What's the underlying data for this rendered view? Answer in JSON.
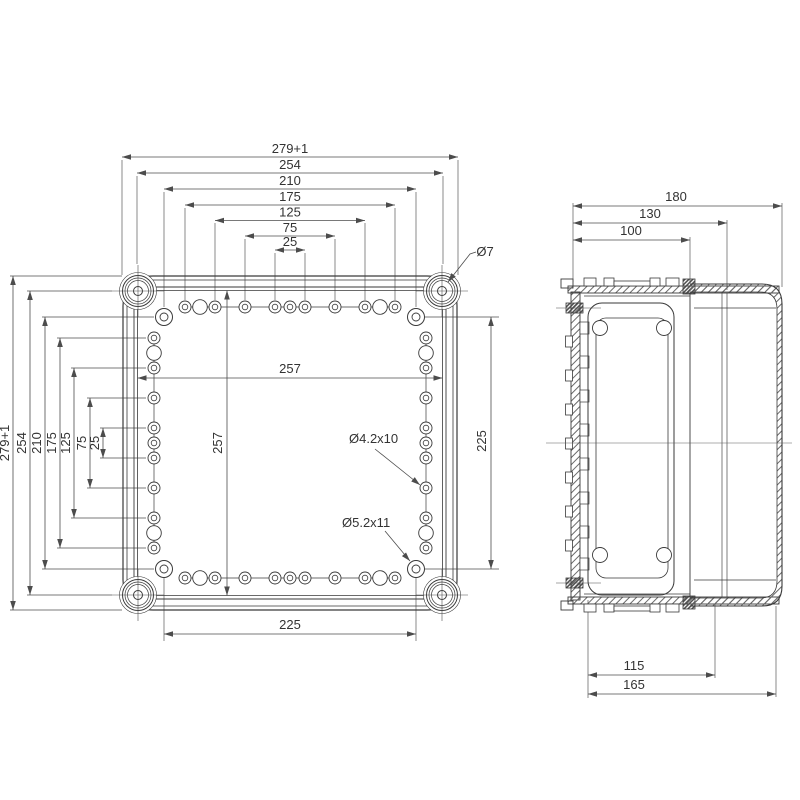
{
  "front_view": {
    "top_chain": [
      "279+1",
      "254",
      "210",
      "175",
      "125",
      "75",
      "25"
    ],
    "left_chain": [
      "279+1",
      "254",
      "210",
      "175",
      "125",
      "75",
      "25"
    ],
    "inner_width": "257",
    "inner_height": "257",
    "right_span": "225",
    "bottom_span": "225",
    "corner_hole_label": "Ø7",
    "small_hole_label": "Ø4.2x10",
    "large_hole_label": "Ø5.2x11"
  },
  "side_view": {
    "top_chain": [
      "180",
      "130",
      "100"
    ],
    "bottom_chain": [
      "115",
      "165"
    ]
  },
  "colors": {
    "line": "#3a3a3a",
    "dim": "#4c4c4c",
    "text": "#333333",
    "background": "#ffffff"
  }
}
